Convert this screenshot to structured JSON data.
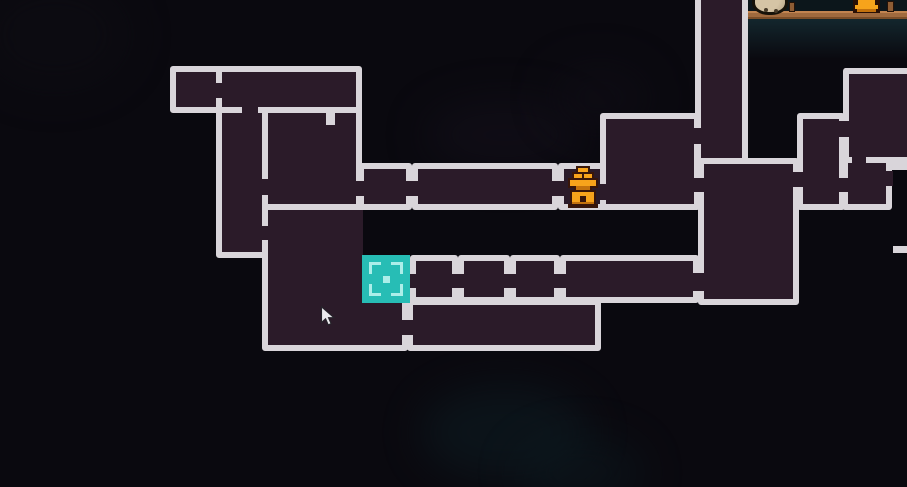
{
  "screen": {
    "type": "game-map-overlay",
    "width": 907,
    "height": 487
  },
  "colors": {
    "background": "#0a090f",
    "room_fill": "#2b1b29",
    "room_border": "#d9d5da",
    "current_room_fill": "#27bdb5",
    "current_room_marks": "#aceee9",
    "bell_amber": "#f7a31b",
    "bell_amber_dark": "#c4720d",
    "bell_outline": "#38160a",
    "scene_sky": "#0c161b",
    "scene_platform": "#a06a3e",
    "scene_character": "#c9b899",
    "cursor_fill": "#ecebee",
    "cursor_outline": "#26242b"
  },
  "map": {
    "rooms": [
      {
        "id": "top-left-small",
        "x": 170,
        "y": 66,
        "w": 52,
        "h": 47
      },
      {
        "id": "top-wide",
        "x": 216,
        "y": 66,
        "w": 146,
        "h": 47
      },
      {
        "id": "left-shaft",
        "x": 216,
        "y": 107,
        "w": 52,
        "h": 151
      },
      {
        "id": "upper-mid",
        "x": 262,
        "y": 107,
        "w": 100,
        "h": 103
      },
      {
        "id": "mid-row-1",
        "x": 358,
        "y": 163,
        "w": 54,
        "h": 47
      },
      {
        "id": "mid-row-2",
        "x": 412,
        "y": 163,
        "w": 146,
        "h": 47
      },
      {
        "id": "bell-room",
        "x": 558,
        "y": 163,
        "w": 52,
        "h": 47
      },
      {
        "id": "mid-right",
        "x": 600,
        "y": 113,
        "w": 100,
        "h": 97
      },
      {
        "id": "top-shaft",
        "x": 695,
        "y": -8,
        "w": 53,
        "h": 176,
        "no_top": true
      },
      {
        "id": "big-right",
        "x": 698,
        "y": 158,
        "w": 101,
        "h": 147
      },
      {
        "id": "right-tall",
        "x": 797,
        "y": 113,
        "w": 48,
        "h": 97
      },
      {
        "id": "far-right-top",
        "x": 843,
        "y": 68,
        "w": 72,
        "h": 95,
        "no_right": true
      },
      {
        "id": "far-right-small",
        "x": 842,
        "y": 157,
        "w": 50,
        "h": 53
      },
      {
        "id": "big-left",
        "x": 262,
        "y": 204,
        "w": 146,
        "h": 147
      },
      {
        "id": "low-row-1",
        "x": 410,
        "y": 255,
        "w": 48,
        "h": 48
      },
      {
        "id": "low-row-2",
        "x": 458,
        "y": 255,
        "w": 52,
        "h": 48
      },
      {
        "id": "low-row-3",
        "x": 510,
        "y": 255,
        "w": 50,
        "h": 48
      },
      {
        "id": "low-row-4",
        "x": 560,
        "y": 255,
        "w": 139,
        "h": 48
      },
      {
        "id": "bottom-wide",
        "x": 407,
        "y": 299,
        "w": 194,
        "h": 52
      }
    ],
    "black_notches": [
      {
        "x": 363,
        "y": 210,
        "w": 45,
        "h": 45
      }
    ],
    "doors": [
      {
        "x": 211,
        "y": 83,
        "w": 12,
        "h": 15
      },
      {
        "x": 242,
        "y": 102,
        "w": 16,
        "h": 12
      },
      {
        "x": 259,
        "y": 179,
        "w": 11,
        "h": 16
      },
      {
        "x": 259,
        "y": 226,
        "w": 11,
        "h": 14
      },
      {
        "x": 354,
        "y": 181,
        "w": 12,
        "h": 15
      },
      {
        "x": 404,
        "y": 181,
        "w": 14,
        "h": 15
      },
      {
        "x": 550,
        "y": 181,
        "w": 14,
        "h": 15
      },
      {
        "x": 598,
        "y": 184,
        "w": 14,
        "h": 16
      },
      {
        "x": 692,
        "y": 128,
        "w": 11,
        "h": 16
      },
      {
        "x": 692,
        "y": 178,
        "w": 12,
        "h": 14
      },
      {
        "x": 791,
        "y": 172,
        "w": 14,
        "h": 15
      },
      {
        "x": 837,
        "y": 121,
        "w": 14,
        "h": 16
      },
      {
        "x": 852,
        "y": 155,
        "w": 14,
        "h": 10
      },
      {
        "x": 836,
        "y": 178,
        "w": 14,
        "h": 14
      },
      {
        "x": 885,
        "y": 171,
        "w": 8,
        "h": 15
      },
      {
        "x": 408,
        "y": 274,
        "w": 10,
        "h": 14
      },
      {
        "x": 450,
        "y": 274,
        "w": 16,
        "h": 14
      },
      {
        "x": 502,
        "y": 274,
        "w": 16,
        "h": 14
      },
      {
        "x": 552,
        "y": 274,
        "w": 16,
        "h": 14
      },
      {
        "x": 690,
        "y": 273,
        "w": 16,
        "h": 18
      },
      {
        "x": 399,
        "y": 320,
        "w": 16,
        "h": 15
      }
    ],
    "nubs": [
      {
        "x": 326,
        "y": 111,
        "w": 9,
        "h": 14
      }
    ],
    "edge_lines": [
      {
        "x": 888,
        "y": 163,
        "w": 19,
        "h": 7
      },
      {
        "x": 893,
        "y": 246,
        "w": 14,
        "h": 7
      }
    ],
    "current_room": {
      "x": 362,
      "y": 255,
      "w": 48,
      "h": 48
    },
    "bell_marker": {
      "x": 564,
      "y": 166,
      "w": 38,
      "h": 42
    }
  },
  "scene": {
    "sky": {
      "x": 747,
      "y": 0,
      "w": 160,
      "h": 12
    },
    "platform": {
      "x": 747,
      "y": 11,
      "w": 160,
      "h": 8
    },
    "underglow": {
      "x": 747,
      "y": 19,
      "w": 160,
      "h": 40
    },
    "character": {
      "x": 752,
      "y": -11,
      "w": 36,
      "h": 26
    },
    "bell": {
      "x": 851,
      "y": 0,
      "w": 31,
      "h": 13
    },
    "posts": [
      {
        "x": 789,
        "y": 2,
        "w": 6,
        "h": 10
      },
      {
        "x": 887,
        "y": 1,
        "w": 7,
        "h": 11
      }
    ]
  },
  "cursor": {
    "x": 320,
    "y": 306,
    "w": 16,
    "h": 22
  }
}
